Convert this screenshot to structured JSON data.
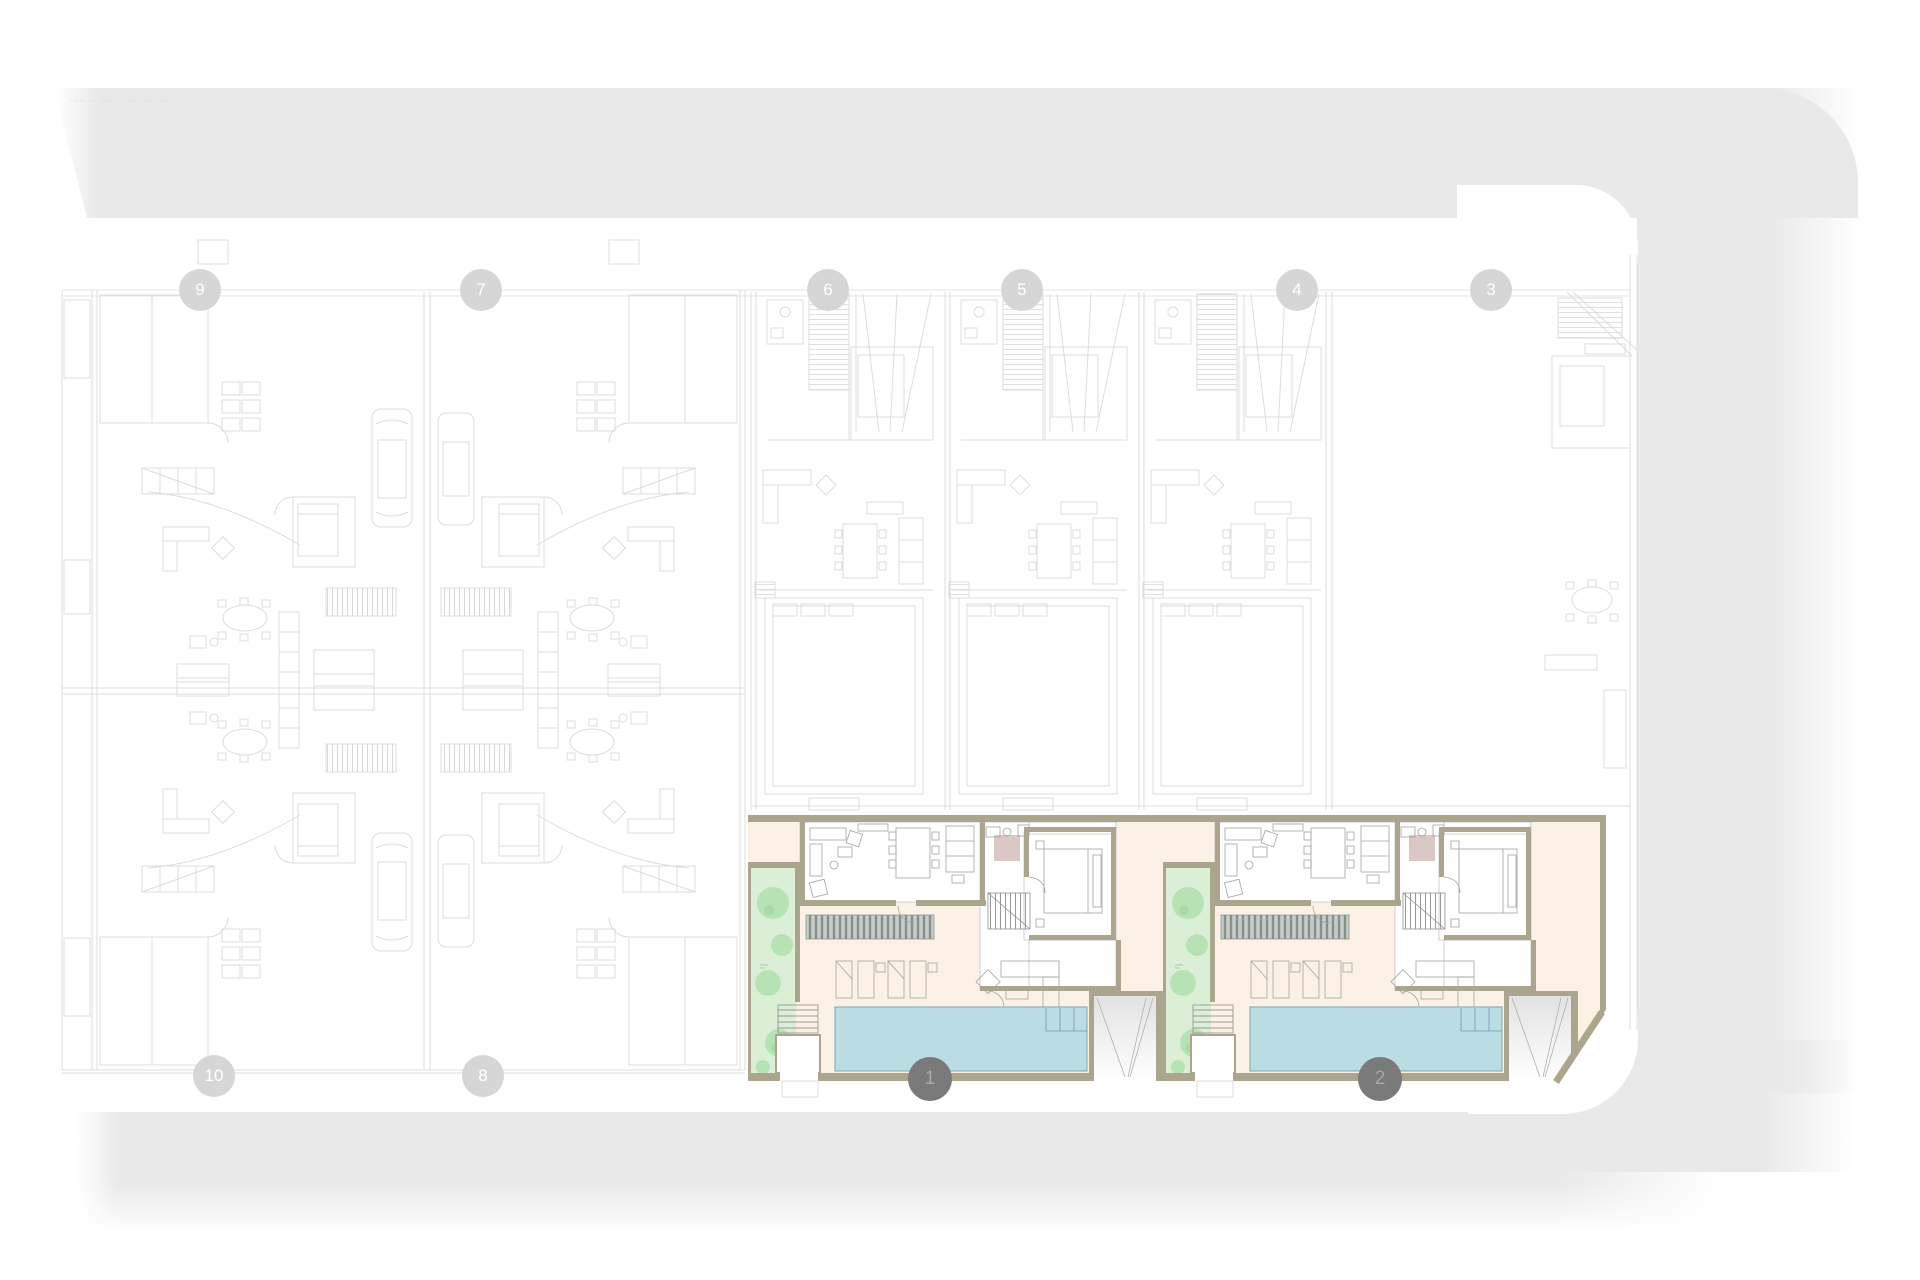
{
  "caption": {
    "text": "∙∙∙∙∙ ∙∙∙ ∙∙∙∙ ∙ ∙ ∙∙∙ ∙∙∙∙∙ ∙∙∙"
  },
  "grid_bubbles": {
    "top": [
      {
        "label": "9"
      },
      {
        "label": "7"
      },
      {
        "label": "6"
      },
      {
        "label": "5"
      },
      {
        "label": "4"
      },
      {
        "label": "3"
      }
    ],
    "bottom": [
      {
        "label": "10"
      },
      {
        "label": "8"
      },
      {
        "label": "1"
      },
      {
        "label": "2"
      }
    ]
  },
  "colors": {
    "street": "#e9e9e9",
    "faint": "#dcdcdc",
    "cream": "#fbf1e4",
    "wall": "#aca58e",
    "pool": "#b9dde2",
    "pool_edge": "#7ea8b1",
    "garden": "#daefd6",
    "tree": "#b7e2b4",
    "tree_dark": "#a6d9a4",
    "pink": "#dbc7c3",
    "badge_faint": "#d6d6d6",
    "badge_dark": "#7a7a7a",
    "badge_dark_text": "#a8a8a8"
  }
}
